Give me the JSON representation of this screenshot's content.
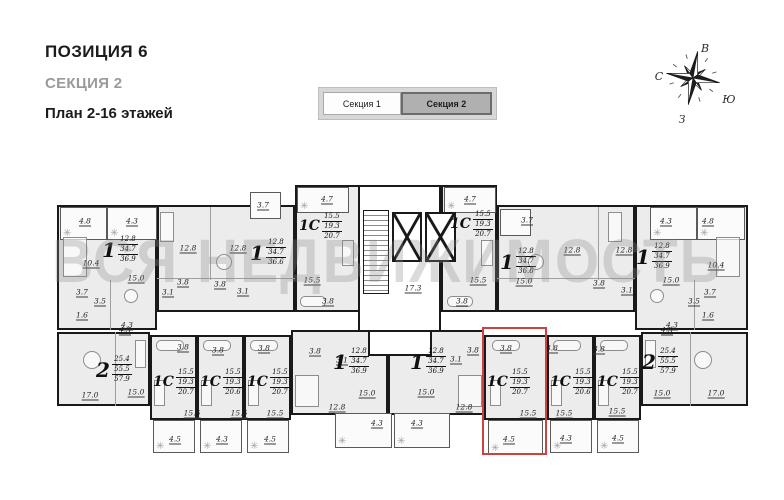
{
  "header": {
    "position": "ПОЗИЦИЯ 6",
    "section": "СЕКЦИЯ 2",
    "plan": "План 2-16 этажей"
  },
  "tabs": {
    "items": [
      {
        "label": "Секция 1",
        "active": false
      },
      {
        "label": "Секция 2",
        "active": true
      }
    ]
  },
  "compass": {
    "north": "С",
    "south": "Ю",
    "east": "В",
    "west": "З"
  },
  "watermark": "ВСЯ НЕДВИЖИМОСТЬ",
  "plan": {
    "highlight_color": "#cf4140",
    "highlight_rect": {
      "x": 482,
      "y": 327,
      "w": 65,
      "h": 128
    },
    "units": [
      {
        "type": "1",
        "areas": [
          "12.8",
          "34.7",
          "36.9"
        ],
        "rect": {
          "x": 57,
          "y": 205,
          "w": 100,
          "h": 125
        },
        "label": {
          "x": 102,
          "y": 235
        }
      },
      {
        "type": "1",
        "areas": [
          "12.8",
          "34.7",
          "36.6"
        ],
        "rect": {
          "x": 157,
          "y": 205,
          "w": 138,
          "h": 107
        },
        "label": {
          "x": 250,
          "y": 238
        }
      },
      {
        "type": "1С",
        "areas": [
          "15.5",
          "19.3",
          "20.7"
        ],
        "rect": {
          "x": 295,
          "y": 185,
          "w": 65,
          "h": 127
        },
        "label": {
          "x": 299,
          "y": 212
        }
      },
      {
        "type": "1С",
        "areas": [
          "15.5",
          "19.3",
          "20.7"
        ],
        "rect": {
          "x": 441,
          "y": 185,
          "w": 56,
          "h": 127
        },
        "label": {
          "x": 450,
          "y": 210
        }
      },
      {
        "type": "1",
        "areas": [
          "12.8",
          "34.7",
          "36.6"
        ],
        "rect": {
          "x": 497,
          "y": 205,
          "w": 138,
          "h": 107
        },
        "label": {
          "x": 500,
          "y": 247
        }
      },
      {
        "type": "1",
        "areas": [
          "12.8",
          "34.7",
          "36.9"
        ],
        "rect": {
          "x": 635,
          "y": 205,
          "w": 113,
          "h": 125
        },
        "label": {
          "x": 636,
          "y": 242
        }
      },
      {
        "type": "2",
        "areas": [
          "25.4",
          "55.5",
          "57.9"
        ],
        "rect": {
          "x": 57,
          "y": 332,
          "w": 93,
          "h": 74
        },
        "label": {
          "x": 96,
          "y": 355
        }
      },
      {
        "type": "1С",
        "areas": [
          "15.5",
          "19.3",
          "20.7"
        ],
        "rect": {
          "x": 150,
          "y": 335,
          "w": 47,
          "h": 85
        },
        "label": {
          "x": 153,
          "y": 368
        }
      },
      {
        "type": "1С",
        "areas": [
          "15.5",
          "19.3",
          "20.6"
        ],
        "rect": {
          "x": 197,
          "y": 335,
          "w": 47,
          "h": 85
        },
        "label": {
          "x": 200,
          "y": 368
        }
      },
      {
        "type": "1С",
        "areas": [
          "15.5",
          "19.3",
          "20.7"
        ],
        "rect": {
          "x": 244,
          "y": 335,
          "w": 47,
          "h": 85
        },
        "label": {
          "x": 247,
          "y": 368
        }
      },
      {
        "type": "1",
        "areas": [
          "12.8",
          "34.7",
          "36.9"
        ],
        "rect": {
          "x": 291,
          "y": 330,
          "w": 97,
          "h": 85
        },
        "label": {
          "x": 333,
          "y": 347
        }
      },
      {
        "type": "1",
        "areas": [
          "12.8",
          "34.7",
          "36.9"
        ],
        "rect": {
          "x": 388,
          "y": 330,
          "w": 96,
          "h": 85
        },
        "label": {
          "x": 410,
          "y": 347
        }
      },
      {
        "type": "1С",
        "areas": [
          "15.5",
          "19.3",
          "20.7"
        ],
        "rect": {
          "x": 484,
          "y": 335,
          "w": 63,
          "h": 85
        },
        "label": {
          "x": 487,
          "y": 368
        },
        "highlighted": true
      },
      {
        "type": "1С",
        "areas": [
          "15.5",
          "19.3",
          "20.6"
        ],
        "rect": {
          "x": 547,
          "y": 335,
          "w": 47,
          "h": 85
        },
        "label": {
          "x": 550,
          "y": 368
        }
      },
      {
        "type": "1С",
        "areas": [
          "15.5",
          "19.3",
          "20.7"
        ],
        "rect": {
          "x": 594,
          "y": 335,
          "w": 47,
          "h": 85
        },
        "label": {
          "x": 597,
          "y": 368
        }
      },
      {
        "type": "2",
        "areas": [
          "25.4",
          "55.5",
          "57.9"
        ],
        "rect": {
          "x": 641,
          "y": 332,
          "w": 107,
          "h": 74
        },
        "label": {
          "x": 642,
          "y": 347
        }
      }
    ],
    "balconies": [
      {
        "rect": {
          "x": 60,
          "y": 207,
          "w": 47,
          "h": 33
        },
        "plants": true
      },
      {
        "rect": {
          "x": 107,
          "y": 207,
          "w": 50,
          "h": 33
        },
        "plants": true
      },
      {
        "rect": {
          "x": 250,
          "y": 192,
          "w": 31,
          "h": 27
        },
        "plants": false
      },
      {
        "rect": {
          "x": 297,
          "y": 187,
          "w": 52,
          "h": 26
        },
        "plants": true
      },
      {
        "rect": {
          "x": 444,
          "y": 187,
          "w": 52,
          "h": 26
        },
        "plants": true
      },
      {
        "rect": {
          "x": 500,
          "y": 209,
          "w": 31,
          "h": 27
        },
        "plants": false
      },
      {
        "rect": {
          "x": 650,
          "y": 207,
          "w": 47,
          "h": 33
        },
        "plants": true
      },
      {
        "rect": {
          "x": 697,
          "y": 207,
          "w": 48,
          "h": 33
        },
        "plants": true
      },
      {
        "rect": {
          "x": 153,
          "y": 420,
          "w": 42,
          "h": 33
        },
        "plants": true
      },
      {
        "rect": {
          "x": 200,
          "y": 420,
          "w": 42,
          "h": 33
        },
        "plants": true
      },
      {
        "rect": {
          "x": 247,
          "y": 420,
          "w": 42,
          "h": 33
        },
        "plants": true
      },
      {
        "rect": {
          "x": 335,
          "y": 413,
          "w": 57,
          "h": 35
        },
        "plants": true
      },
      {
        "rect": {
          "x": 394,
          "y": 413,
          "w": 56,
          "h": 35
        },
        "plants": true
      },
      {
        "rect": {
          "x": 488,
          "y": 420,
          "w": 55,
          "h": 35
        },
        "plants": true
      },
      {
        "rect": {
          "x": 550,
          "y": 420,
          "w": 42,
          "h": 33
        },
        "plants": true
      },
      {
        "rect": {
          "x": 597,
          "y": 420,
          "w": 42,
          "h": 33
        },
        "plants": true
      }
    ],
    "room_labels": [
      {
        "text": "4.8",
        "x": 85,
        "y": 222
      },
      {
        "text": "4.3",
        "x": 132,
        "y": 222
      },
      {
        "text": "10.4",
        "x": 91,
        "y": 264
      },
      {
        "text": "15.0",
        "x": 136,
        "y": 279
      },
      {
        "text": "12.8",
        "x": 188,
        "y": 249
      },
      {
        "text": "12.8",
        "x": 238,
        "y": 249
      },
      {
        "text": "3.8",
        "x": 183,
        "y": 283
      },
      {
        "text": "3.1",
        "x": 168,
        "y": 293
      },
      {
        "text": "3.8",
        "x": 220,
        "y": 285
      },
      {
        "text": "3.1",
        "x": 243,
        "y": 292
      },
      {
        "text": "3.7",
        "x": 82,
        "y": 293
      },
      {
        "text": "3.5",
        "x": 100,
        "y": 302
      },
      {
        "text": "1.6",
        "x": 82,
        "y": 316
      },
      {
        "text": "4.3",
        "x": 127,
        "y": 326
      },
      {
        "text": "3.7",
        "x": 263,
        "y": 206
      },
      {
        "text": "4.7",
        "x": 327,
        "y": 200
      },
      {
        "text": "15.5",
        "x": 312,
        "y": 281
      },
      {
        "text": "3.8",
        "x": 328,
        "y": 302
      },
      {
        "text": "17.3",
        "x": 413,
        "y": 289
      },
      {
        "text": "4.7",
        "x": 470,
        "y": 200
      },
      {
        "text": "15.5",
        "x": 478,
        "y": 281
      },
      {
        "text": "3.8",
        "x": 462,
        "y": 302
      },
      {
        "text": "3.7",
        "x": 527,
        "y": 221
      },
      {
        "text": "15.0",
        "x": 524,
        "y": 282
      },
      {
        "text": "12.8",
        "x": 572,
        "y": 251
      },
      {
        "text": "3.8",
        "x": 599,
        "y": 284
      },
      {
        "text": "3.1",
        "x": 627,
        "y": 291
      },
      {
        "text": "12.8",
        "x": 624,
        "y": 251
      },
      {
        "text": "15.0",
        "x": 671,
        "y": 281
      },
      {
        "text": "10.4",
        "x": 716,
        "y": 266
      },
      {
        "text": "3.7",
        "x": 710,
        "y": 293
      },
      {
        "text": "3.5",
        "x": 694,
        "y": 302
      },
      {
        "text": "1.6",
        "x": 708,
        "y": 316
      },
      {
        "text": "4.3",
        "x": 672,
        "y": 326
      },
      {
        "text": "4.3",
        "x": 666,
        "y": 222
      },
      {
        "text": "4.8",
        "x": 708,
        "y": 222
      },
      {
        "text": "17.0",
        "x": 90,
        "y": 396
      },
      {
        "text": "15.0",
        "x": 136,
        "y": 393
      },
      {
        "text": "4.3",
        "x": 125,
        "y": 331
      },
      {
        "text": "3.8",
        "x": 183,
        "y": 348
      },
      {
        "text": "15.5",
        "x": 192,
        "y": 414
      },
      {
        "text": "4.5",
        "x": 175,
        "y": 440
      },
      {
        "text": "3.8",
        "x": 218,
        "y": 351
      },
      {
        "text": "15.5",
        "x": 239,
        "y": 414
      },
      {
        "text": "4.3",
        "x": 222,
        "y": 440
      },
      {
        "text": "3.8",
        "x": 264,
        "y": 349
      },
      {
        "text": "15.5",
        "x": 275,
        "y": 414
      },
      {
        "text": "4.5",
        "x": 270,
        "y": 440
      },
      {
        "text": "3.8",
        "x": 315,
        "y": 352
      },
      {
        "text": "3.1",
        "x": 342,
        "y": 361
      },
      {
        "text": "12.8",
        "x": 337,
        "y": 408
      },
      {
        "text": "15.0",
        "x": 367,
        "y": 394
      },
      {
        "text": "4.3",
        "x": 377,
        "y": 424
      },
      {
        "text": "3.8",
        "x": 473,
        "y": 351
      },
      {
        "text": "3.1",
        "x": 456,
        "y": 360
      },
      {
        "text": "12.8",
        "x": 464,
        "y": 408
      },
      {
        "text": "15.0",
        "x": 426,
        "y": 393
      },
      {
        "text": "4.3",
        "x": 417,
        "y": 424
      },
      {
        "text": "3.8",
        "x": 506,
        "y": 349
      },
      {
        "text": "15.5",
        "x": 528,
        "y": 414
      },
      {
        "text": "4.5",
        "x": 509,
        "y": 440
      },
      {
        "text": "3.8",
        "x": 552,
        "y": 349
      },
      {
        "text": "15.5",
        "x": 564,
        "y": 414
      },
      {
        "text": "4.3",
        "x": 566,
        "y": 439
      },
      {
        "text": "3.8",
        "x": 599,
        "y": 350
      },
      {
        "text": "15.5",
        "x": 617,
        "y": 412
      },
      {
        "text": "4.5",
        "x": 618,
        "y": 439
      },
      {
        "text": "15.0",
        "x": 662,
        "y": 394
      },
      {
        "text": "17.0",
        "x": 716,
        "y": 394
      },
      {
        "text": "4.3",
        "x": 667,
        "y": 331
      }
    ],
    "partitions": [
      {
        "x": 210,
        "y": 207,
        "w": 1,
        "h": 73
      },
      {
        "x": 157,
        "y": 278,
        "w": 138,
        "h": 1
      },
      {
        "x": 598,
        "y": 207,
        "w": 1,
        "h": 73
      },
      {
        "x": 497,
        "y": 278,
        "w": 138,
        "h": 1
      },
      {
        "x": 115,
        "y": 332,
        "w": 1,
        "h": 74
      },
      {
        "x": 690,
        "y": 332,
        "w": 1,
        "h": 74
      },
      {
        "x": 110,
        "y": 280,
        "w": 1,
        "h": 50
      },
      {
        "x": 694,
        "y": 280,
        "w": 1,
        "h": 50
      }
    ],
    "furniture": [
      {
        "k": "c",
        "x": 124,
        "y": 289,
        "w": 14,
        "h": 14
      },
      {
        "k": "r",
        "x": 63,
        "y": 237,
        "w": 24,
        "h": 40
      },
      {
        "k": "c",
        "x": 216,
        "y": 254,
        "w": 16,
        "h": 16
      },
      {
        "k": "r",
        "x": 160,
        "y": 212,
        "w": 14,
        "h": 30
      },
      {
        "k": "t",
        "x": 300,
        "y": 296,
        "w": 26,
        "h": 11
      },
      {
        "k": "r",
        "x": 342,
        "y": 240,
        "w": 12,
        "h": 26
      },
      {
        "k": "t",
        "x": 447,
        "y": 296,
        "w": 26,
        "h": 11
      },
      {
        "k": "r",
        "x": 481,
        "y": 240,
        "w": 12,
        "h": 26
      },
      {
        "k": "c",
        "x": 528,
        "y": 254,
        "w": 16,
        "h": 16
      },
      {
        "k": "r",
        "x": 608,
        "y": 212,
        "w": 14,
        "h": 30
      },
      {
        "k": "c",
        "x": 650,
        "y": 289,
        "w": 14,
        "h": 14
      },
      {
        "k": "r",
        "x": 716,
        "y": 237,
        "w": 24,
        "h": 40
      },
      {
        "k": "c",
        "x": 83,
        "y": 351,
        "w": 18,
        "h": 18
      },
      {
        "k": "r",
        "x": 135,
        "y": 340,
        "w": 11,
        "h": 28
      },
      {
        "k": "t",
        "x": 156,
        "y": 340,
        "w": 28,
        "h": 11
      },
      {
        "k": "t",
        "x": 203,
        "y": 340,
        "w": 28,
        "h": 11
      },
      {
        "k": "t",
        "x": 250,
        "y": 340,
        "w": 28,
        "h": 11
      },
      {
        "k": "t",
        "x": 492,
        "y": 340,
        "w": 28,
        "h": 11
      },
      {
        "k": "t",
        "x": 553,
        "y": 340,
        "w": 28,
        "h": 11
      },
      {
        "k": "t",
        "x": 600,
        "y": 340,
        "w": 28,
        "h": 11
      },
      {
        "k": "r",
        "x": 154,
        "y": 380,
        "w": 11,
        "h": 26
      },
      {
        "k": "r",
        "x": 201,
        "y": 380,
        "w": 11,
        "h": 26
      },
      {
        "k": "r",
        "x": 248,
        "y": 380,
        "w": 11,
        "h": 26
      },
      {
        "k": "r",
        "x": 490,
        "y": 380,
        "w": 11,
        "h": 26
      },
      {
        "k": "r",
        "x": 551,
        "y": 380,
        "w": 11,
        "h": 26
      },
      {
        "k": "r",
        "x": 598,
        "y": 380,
        "w": 11,
        "h": 26
      },
      {
        "k": "r",
        "x": 295,
        "y": 375,
        "w": 24,
        "h": 32
      },
      {
        "k": "r",
        "x": 458,
        "y": 375,
        "w": 24,
        "h": 32
      },
      {
        "k": "c",
        "x": 694,
        "y": 351,
        "w": 18,
        "h": 18
      },
      {
        "k": "r",
        "x": 645,
        "y": 340,
        "w": 11,
        "h": 28
      }
    ],
    "core": {
      "box": {
        "x": 358,
        "y": 185,
        "w": 83,
        "h": 147
      },
      "stairs": {
        "x": 363,
        "y": 210,
        "w": 26,
        "h": 84
      },
      "elevators": [
        {
          "x": 392,
          "y": 212,
          "w": 30,
          "h": 50
        },
        {
          "x": 425,
          "y": 212,
          "w": 31,
          "h": 50
        }
      ],
      "vestibule": {
        "x": 368,
        "y": 330,
        "w": 64,
        "h": 26
      }
    }
  }
}
